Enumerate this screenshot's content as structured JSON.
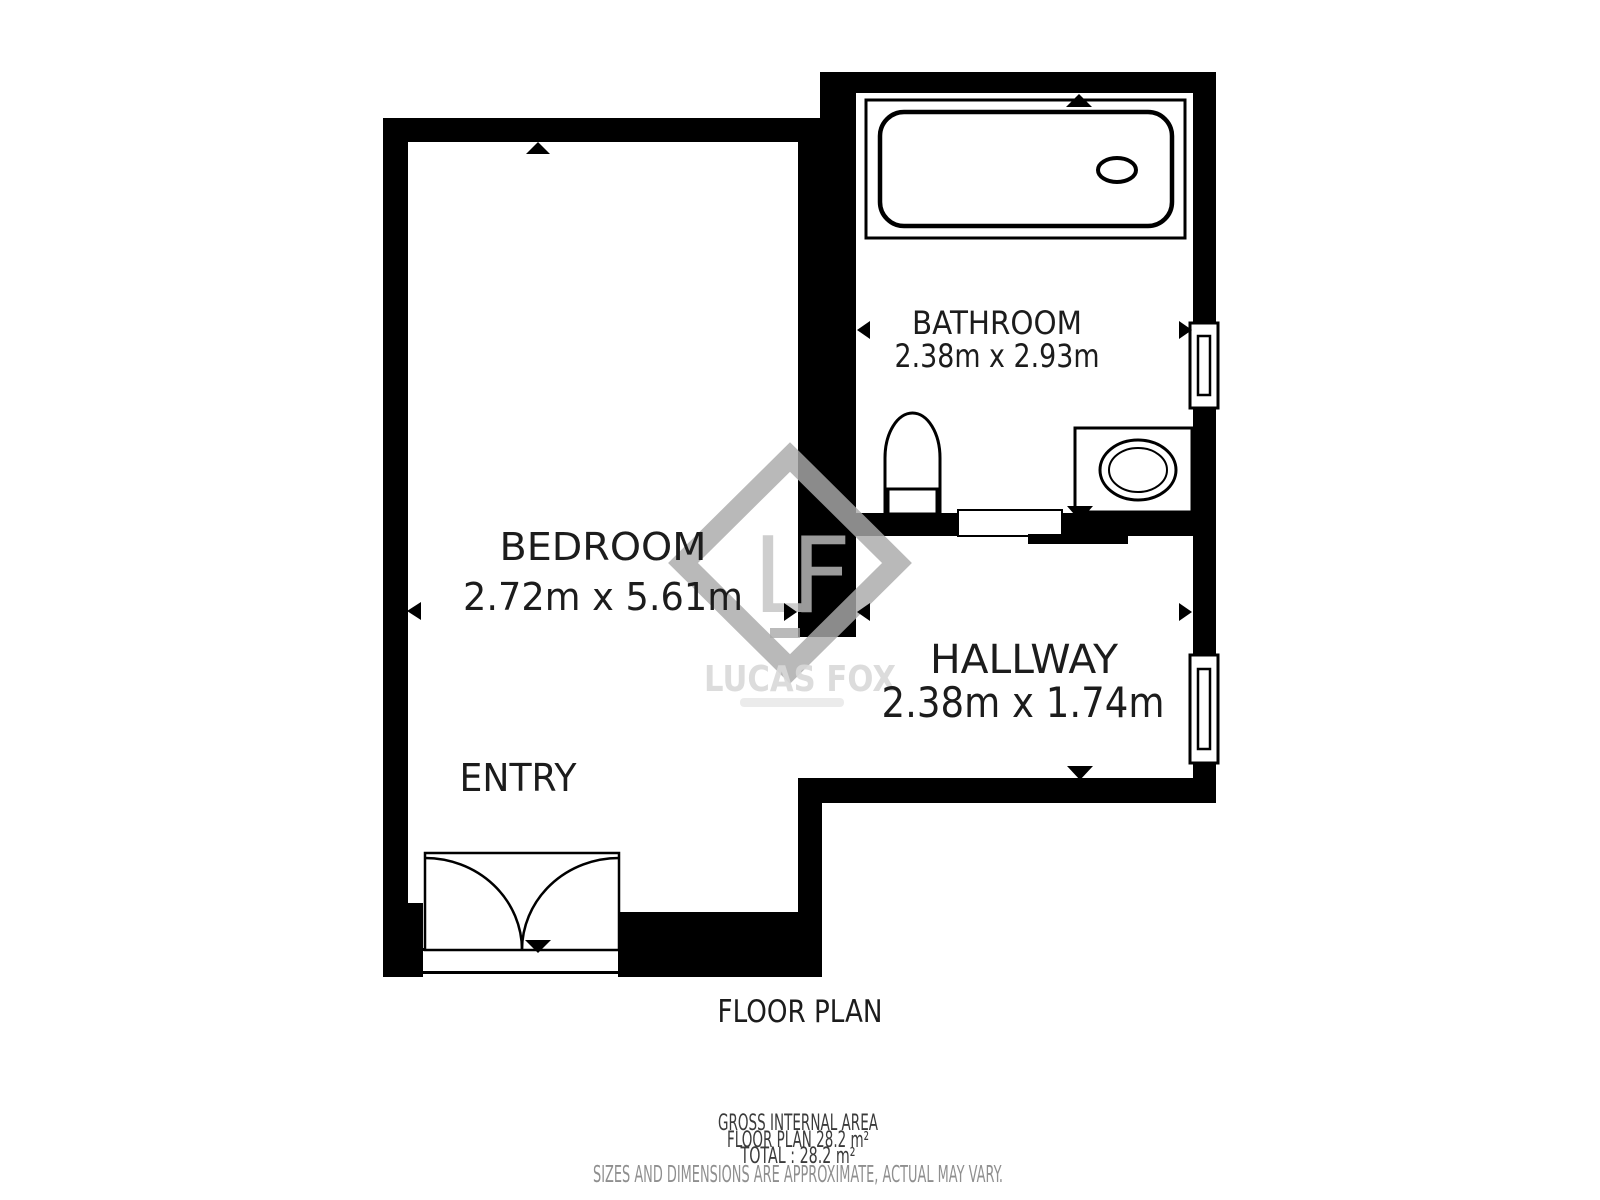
{
  "title": "FLOOR PLAN",
  "rooms": [
    {
      "name": "BEDROOM",
      "dimensions": "2.72m x 5.61m"
    },
    {
      "name": "BATHROOM",
      "dimensions": "2.38m x 2.93m"
    },
    {
      "name": "HALLWAY",
      "dimensions": "2.38m x 1.74m"
    }
  ],
  "labels": {
    "entry": "ENTRY"
  },
  "watermark": {
    "monogram": "LF",
    "brand": "LUCAS FOX"
  },
  "footer": {
    "gross_internal_area": "GROSS INTERNAL AREA",
    "floor_plan_area": "FLOOR PLAN 28.2 m²",
    "total_area": "TOTAL :  28.2 m²",
    "disclaimer": "SIZES AND DIMENSIONS ARE APPROXIMATE, ACTUAL MAY VARY."
  },
  "symbols": {
    "fixtures": [
      "bathtub-icon",
      "toilet-icon",
      "sink-icon"
    ],
    "doors": [
      "double-swing-door-icon",
      "sliding-door-icon"
    ],
    "windows": [
      "window-icon",
      "window-icon"
    ],
    "markers": [
      "dimension-arrow-icon"
    ]
  },
  "colors": {
    "wall": "#000000",
    "background": "#ffffff",
    "label_text": "#1c1c1c",
    "watermark_gray": "#a9a9a9",
    "brand_gray": "#d9d9d9",
    "footer_text": "#3b3b3b",
    "disclaimer_text": "#8f8f8f"
  }
}
